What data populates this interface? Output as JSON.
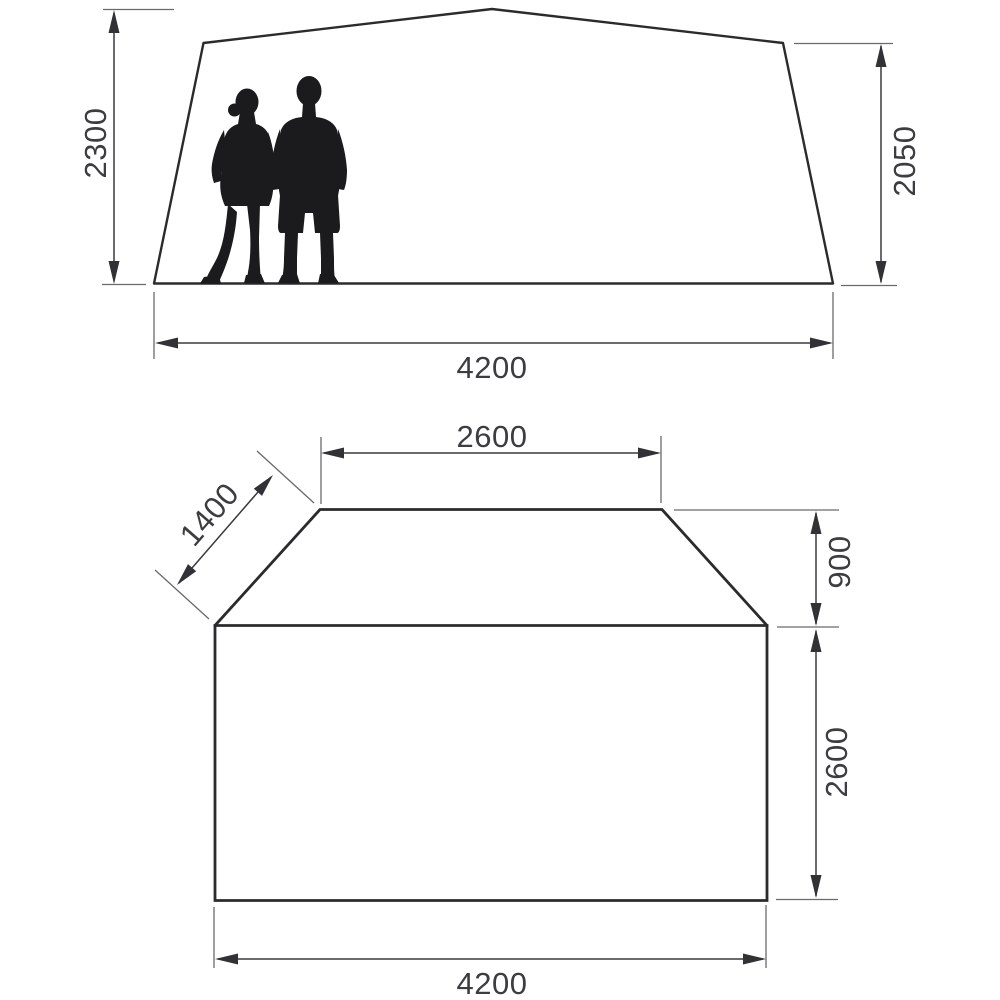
{
  "page": {
    "background_color": "#ffffff",
    "description_labels": {
      "side_view_name": "tent side elevation",
      "floor_plan_name": "tent floor plan"
    }
  },
  "colors": {
    "outline": "#2b2b2e",
    "dimension_line": "#3a3a3e",
    "extension_line": "#6a6a6e",
    "label_text": "#3d3d41",
    "silhouette": "#1b1b1d"
  },
  "side_view": {
    "peak_height_label": "2300",
    "side_height_label": "2050",
    "width_label": "4200"
  },
  "floor_plan": {
    "front_width_label": "2600",
    "side_panel_label": "1400",
    "front_depth_label": "900",
    "main_depth_label": "2600",
    "total_width_label": "4200"
  }
}
